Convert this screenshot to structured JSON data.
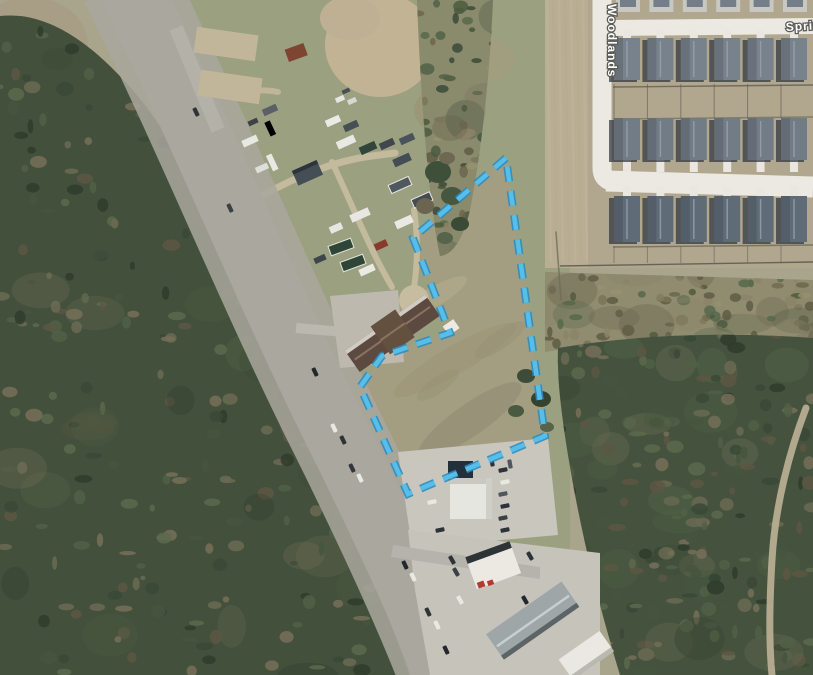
{
  "map": {
    "description": "Aerial satellite view of a highway corridor with a highlighted road and a dashed parcel boundary annotation",
    "labels": {
      "street_vertical": "Woodlands",
      "street_horizontal": "Sprin"
    },
    "parcel_boundary": {
      "points": "506,158 413,238 450,333 382,356 360,387 408,494 545,436",
      "stroke": "#57bde9",
      "casing": "#2e8cbe",
      "dash": "15 9.5",
      "stroke_width": "4.6",
      "casing_width": "7.8"
    },
    "highway": {
      "centerline": "M 130,-12 C 200,128 262,282 332,424 C 382,524 424,614 452,688",
      "highlight_color": "#f1e93f",
      "highlight_opacity": "0.8"
    }
  }
}
